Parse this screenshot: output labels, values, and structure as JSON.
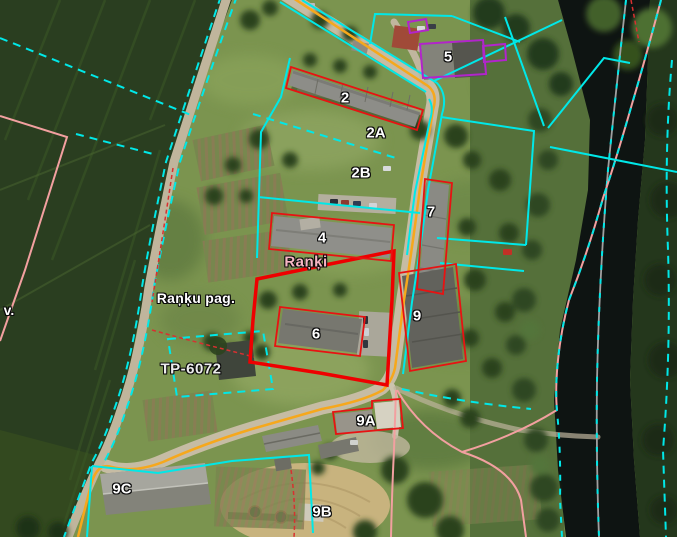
{
  "map_labels": {
    "building_2": "2",
    "building_2a": "2A",
    "building_2b": "2B",
    "building_4": "4",
    "building_5": "5",
    "building_6": "6",
    "building_7": "7",
    "building_9": "9",
    "building_9a": "9A",
    "building_9b": "9B",
    "building_9c": "9C",
    "settlement": "Raņķi",
    "parish": "Raņķu pag.",
    "transformer_point": "TP-6072",
    "village_abbrev": "v."
  },
  "legend_colors": {
    "parcel_boundary_cyan": "#00e8e8",
    "selected_parcel_red": "#ee0000",
    "building_outline_red": "#e81212",
    "protected_object_purple": "#b224cc",
    "road_centerline_orange": "#f6a81c",
    "administrative_boundary_pink": "#f2a0a0",
    "river_axis_grey": "#a0a0a0",
    "label_text_white": "#ffffff",
    "settlement_label_pink": "#f7b6c4"
  }
}
